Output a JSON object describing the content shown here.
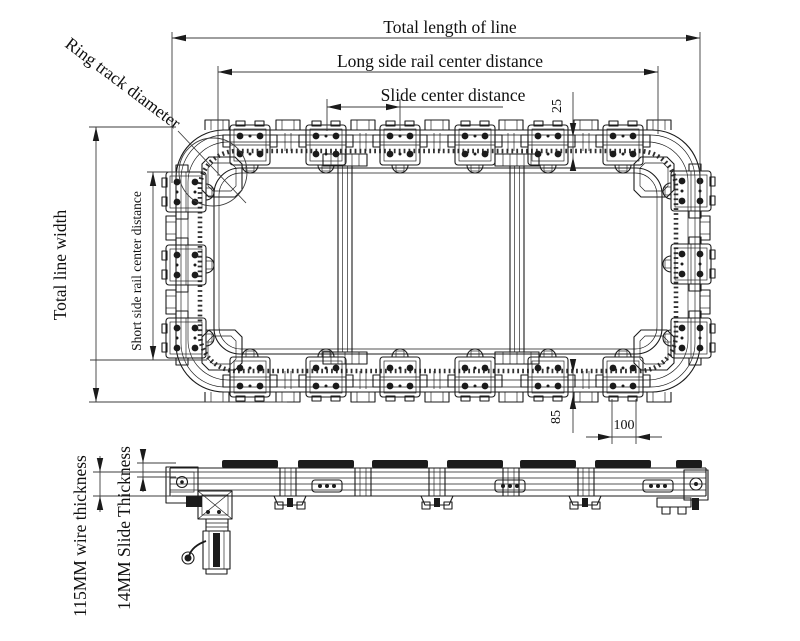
{
  "drawing": {
    "ink": "#1b1b1b",
    "paper": "#ffffff"
  },
  "plan_view": {
    "total_length_label": "Total length of line",
    "long_side_label": "Long side rail center distance",
    "slide_center_label": "Slide center distance",
    "ring_track_label": "Ring track diameter",
    "total_width_label": "Total line width",
    "short_side_label": "Short side rail center distance",
    "offset_top_mm": "25",
    "offset_bottom_mm": "85",
    "slide_pitch_mm": "100"
  },
  "side_view": {
    "wire_thickness_label": "115MM wire thickness",
    "slide_thickness_label": "14MM Slide Thickness"
  }
}
